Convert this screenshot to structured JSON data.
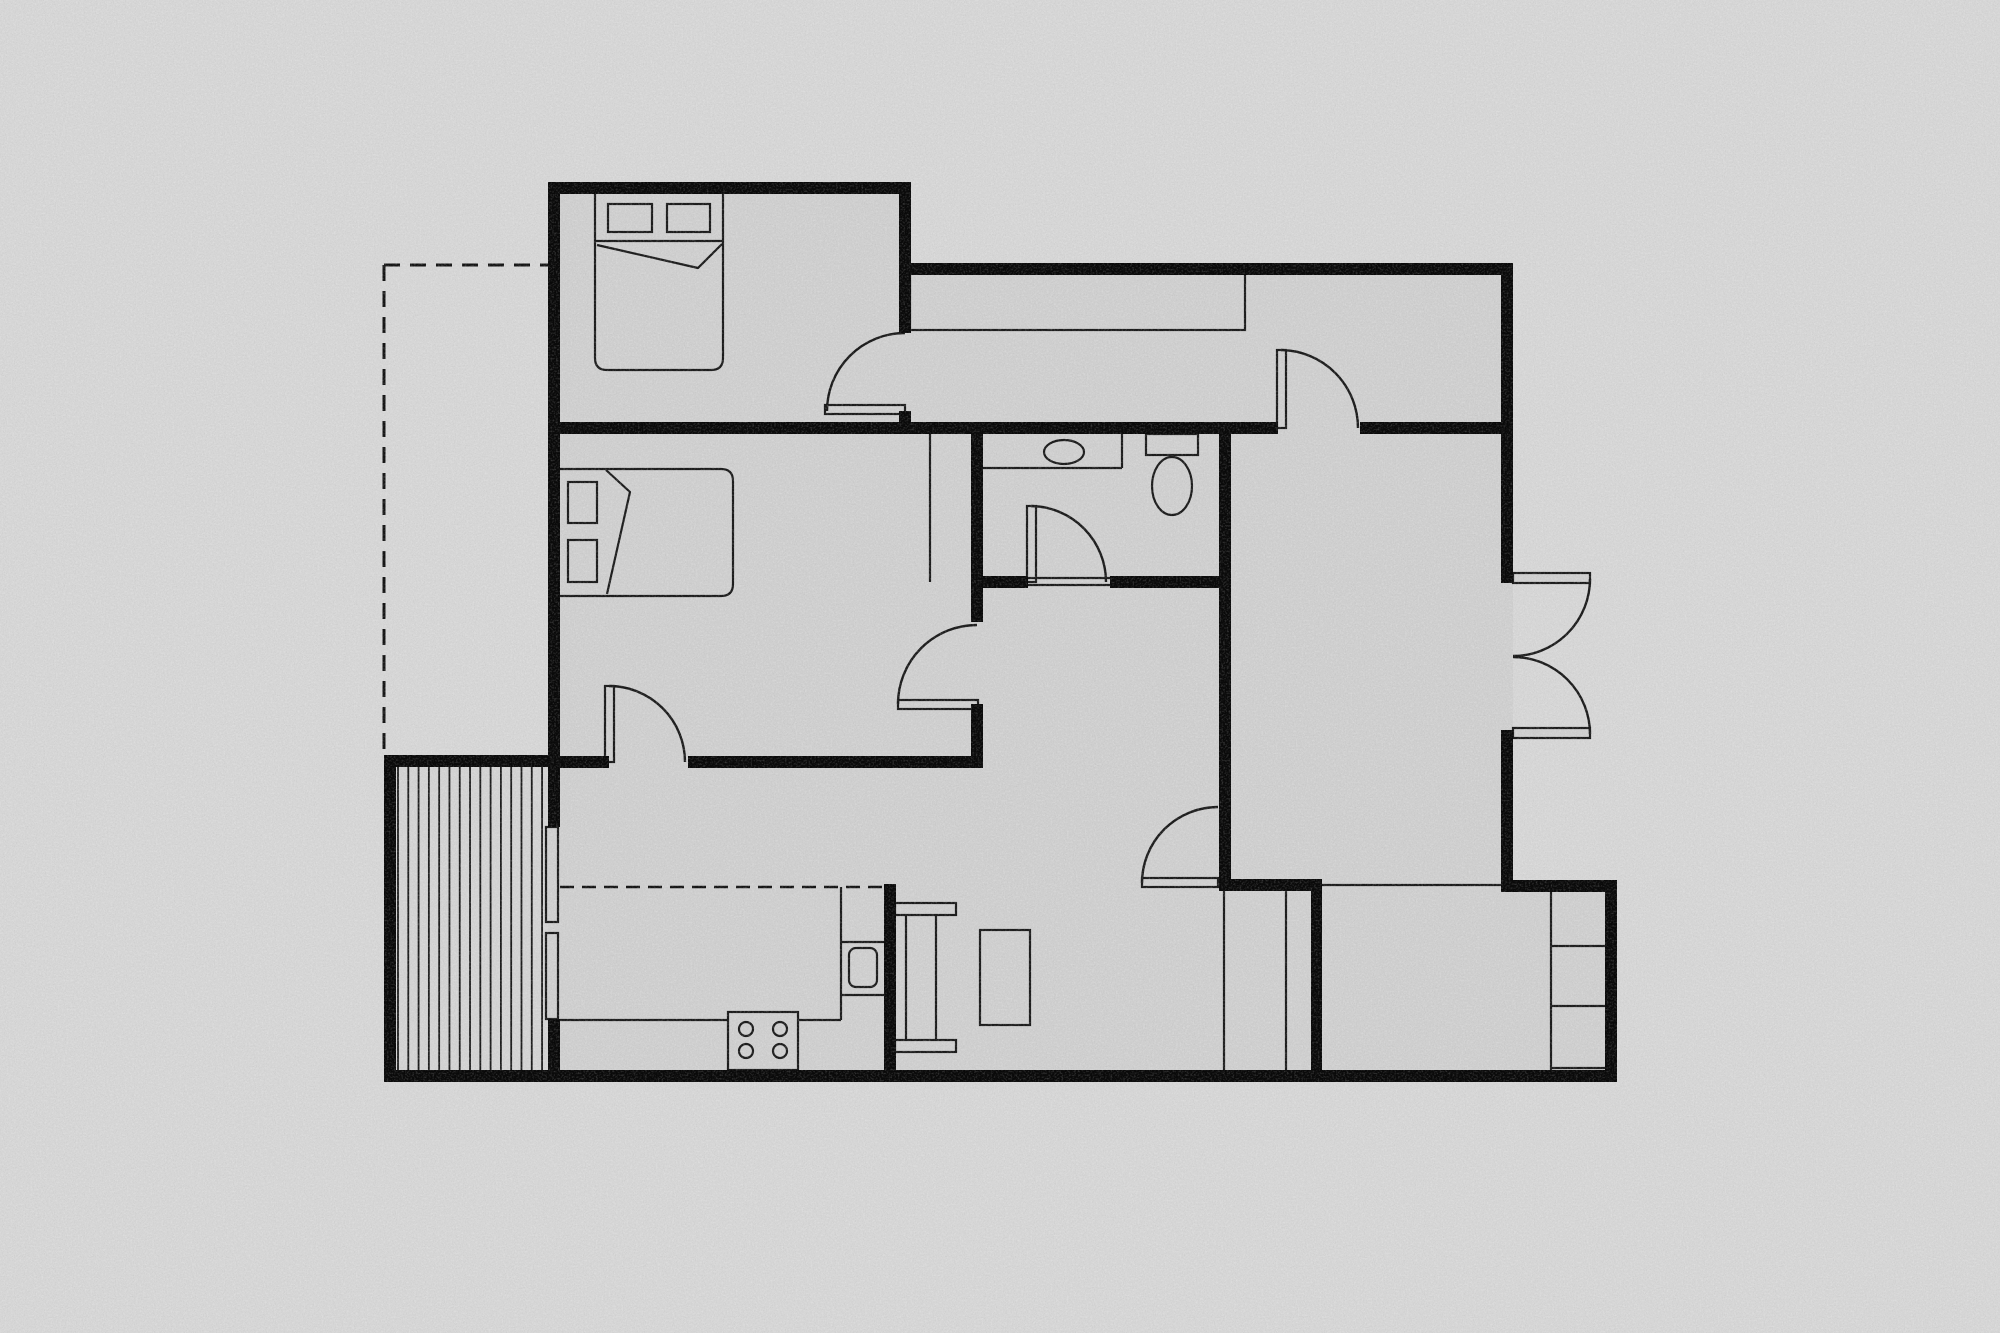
{
  "scene": {
    "width": 2000,
    "height": 1333,
    "background": "#d6d6d6",
    "floor_fill": "#cfcfcf",
    "deck_fill": "#d3d3d3",
    "wall_color": "#0a0a0a",
    "line_color": "#1c1c1c",
    "dash_color": "#151515",
    "thin_width": 2.2,
    "arc_width": 2.4
  },
  "floor_plan": {
    "floor": {
      "name": "floor-footprint",
      "points": "548,182 910,182 910,263 1513,263 1513,880 1617,880 1617,1082 384,1082 384,755 548,755"
    },
    "deck": {
      "name": "deck-patio",
      "x": 396,
      "y": 767,
      "w": 152,
      "h": 303,
      "stripe_x0": 398,
      "stripe_step": 10.29,
      "stripe_count": 15,
      "stripe_y0": 767,
      "stripe_y1": 1070
    },
    "walls": [
      {
        "name": "wall-left-upper",
        "x": 548,
        "y": 182,
        "w": 12,
        "h": 645
      },
      {
        "name": "wall-left-lower",
        "x": 548,
        "y": 1019,
        "w": 12,
        "h": 63
      },
      {
        "name": "wall-top-bedroom1",
        "x": 548,
        "y": 182,
        "w": 363,
        "h": 12
      },
      {
        "name": "wall-bedroom1-right-upper",
        "x": 899,
        "y": 182,
        "w": 12,
        "h": 151
      },
      {
        "name": "wall-bedroom1-right-stub",
        "x": 899,
        "y": 411,
        "w": 12,
        "h": 23
      },
      {
        "name": "wall-hall-top",
        "x": 905,
        "y": 263,
        "w": 608,
        "h": 12
      },
      {
        "name": "wall-right-upper",
        "x": 1501,
        "y": 263,
        "w": 12,
        "h": 320
      },
      {
        "name": "wall-right-lower",
        "x": 1501,
        "y": 730,
        "w": 12,
        "h": 162
      },
      {
        "name": "wall-step-top",
        "x": 1501,
        "y": 880,
        "w": 116,
        "h": 12
      },
      {
        "name": "wall-right-outer",
        "x": 1605,
        "y": 880,
        "w": 12,
        "h": 202
      },
      {
        "name": "wall-bottom",
        "x": 384,
        "y": 1070,
        "w": 1233,
        "h": 12
      },
      {
        "name": "wall-deck-left",
        "x": 384,
        "y": 755,
        "w": 12,
        "h": 327
      },
      {
        "name": "wall-deck-top",
        "x": 384,
        "y": 755,
        "w": 172,
        "h": 12
      },
      {
        "name": "wall-cross-main-left",
        "x": 548,
        "y": 422,
        "w": 730,
        "h": 12
      },
      {
        "name": "wall-cross-main-right",
        "x": 1360,
        "y": 422,
        "w": 153,
        "h": 12
      },
      {
        "name": "wall-a-upper",
        "x": 971,
        "y": 434,
        "w": 12,
        "h": 188
      },
      {
        "name": "wall-a-lower",
        "x": 971,
        "y": 704,
        "w": 12,
        "h": 64
      },
      {
        "name": "wall-bedroom2-bottom-left",
        "x": 548,
        "y": 756,
        "w": 61,
        "h": 12
      },
      {
        "name": "wall-bedroom2-bottom-right",
        "x": 688,
        "y": 756,
        "w": 295,
        "h": 12
      },
      {
        "name": "wall-bath-bottom-left",
        "x": 971,
        "y": 576,
        "w": 57,
        "h": 12
      },
      {
        "name": "wall-bath-bottom-right",
        "x": 1110,
        "y": 576,
        "w": 121,
        "h": 12
      },
      {
        "name": "wall-b",
        "x": 1219,
        "y": 434,
        "w": 12,
        "h": 451
      },
      {
        "name": "wall-kitchen-dining",
        "x": 884,
        "y": 884,
        "w": 12,
        "h": 198
      },
      {
        "name": "wall-closet-top",
        "x": 1219,
        "y": 879,
        "w": 103,
        "h": 12
      },
      {
        "name": "wall-closet-right",
        "x": 1311,
        "y": 885,
        "w": 11,
        "h": 187
      }
    ],
    "thin_lines": [
      {
        "name": "rightroom-bottom-line",
        "pts": [
          1322,
          885,
          1501,
          885
        ]
      },
      {
        "name": "closet-divider-1",
        "pts": [
          1224,
          891,
          1224,
          1070
        ]
      },
      {
        "name": "closet-divider-2",
        "pts": [
          1286,
          891,
          1286,
          1070
        ]
      },
      {
        "name": "shelf-closet-left",
        "pts": [
          1551,
          892,
          1551,
          1070
        ]
      },
      {
        "name": "shelf-closet-div-1",
        "pts": [
          1551,
          946,
          1605,
          946
        ]
      },
      {
        "name": "shelf-closet-div-2",
        "pts": [
          1551,
          1006,
          1605,
          1006
        ]
      },
      {
        "name": "shelf-closet-bottom",
        "pts": [
          1551,
          1068,
          1605,
          1068
        ]
      },
      {
        "name": "bedroom2-wardrobe-line",
        "pts": [
          930,
          434,
          930,
          582
        ]
      },
      {
        "name": "kitchen-counter-front-left",
        "pts": [
          560,
          1020,
          728,
          1020
        ]
      },
      {
        "name": "kitchen-counter-front-mid",
        "pts": [
          798,
          1020,
          841,
          1020
        ]
      },
      {
        "name": "kitchen-counter-side",
        "pts": [
          841,
          887,
          841,
          1020
        ]
      },
      {
        "name": "kitchen-counter-div-1",
        "pts": [
          841,
          942,
          884,
          942
        ]
      },
      {
        "name": "kitchen-counter-div-2",
        "pts": [
          841,
          995,
          884,
          995
        ]
      },
      {
        "name": "vanity-front",
        "pts": [
          983,
          468,
          1122,
          468
        ]
      },
      {
        "name": "vanity-side",
        "pts": [
          1122,
          434,
          1122,
          468
        ]
      },
      {
        "name": "bed1-head-line",
        "pts": [
          595,
          241,
          723,
          241
        ]
      },
      {
        "name": "bath-door-threshold-1",
        "pts": [
          1028,
          578,
          1110,
          578
        ]
      },
      {
        "name": "bath-door-threshold-2",
        "pts": [
          1028,
          585,
          1110,
          585
        ]
      },
      {
        "name": "console-leg-1",
        "pts": [
          906,
          915,
          906,
          1040
        ]
      },
      {
        "name": "console-leg-2",
        "pts": [
          936,
          915,
          936,
          1040
        ]
      }
    ],
    "dashed_lines": [
      {
        "name": "dashed-boundary-top",
        "pts": [
          384,
          265,
          548,
          265
        ],
        "dash": "16 10",
        "w": 3
      },
      {
        "name": "dashed-boundary-left",
        "pts": [
          384,
          265,
          384,
          755
        ],
        "dash": "16 10",
        "w": 3
      },
      {
        "name": "dashed-kitchen-overhead",
        "pts": [
          560,
          887,
          884,
          887
        ],
        "dash": "14 8",
        "w": 2.5
      }
    ],
    "outline_rects": [
      {
        "name": "hall-closet",
        "x": 910,
        "y": 272,
        "w": 335,
        "h": 58
      },
      {
        "name": "window-left-upper",
        "x": 546,
        "y": 827,
        "w": 12,
        "h": 95
      },
      {
        "name": "window-left-lower",
        "x": 546,
        "y": 933,
        "w": 12,
        "h": 86
      },
      {
        "name": "bed1-pillow-left",
        "x": 608,
        "y": 204,
        "w": 44,
        "h": 28
      },
      {
        "name": "bed1-pillow-right",
        "x": 667,
        "y": 204,
        "w": 43,
        "h": 28
      },
      {
        "name": "bed2-pillow-top",
        "x": 568,
        "y": 482,
        "w": 29,
        "h": 41
      },
      {
        "name": "bed2-pillow-bottom",
        "x": 568,
        "y": 540,
        "w": 29,
        "h": 42
      },
      {
        "name": "stove",
        "x": 728,
        "y": 1012,
        "w": 70,
        "h": 58
      },
      {
        "name": "kitchen-sink",
        "x": 849,
        "y": 948,
        "w": 28,
        "h": 39,
        "rx": 7
      },
      {
        "name": "toilet-tank",
        "x": 1146,
        "y": 434,
        "w": 52,
        "h": 21
      },
      {
        "name": "console-cap-top",
        "x": 895,
        "y": 903,
        "w": 61,
        "h": 12
      },
      {
        "name": "console-cap-bottom",
        "x": 895,
        "y": 1040,
        "w": 61,
        "h": 12
      },
      {
        "name": "dining-table",
        "x": 980,
        "y": 930,
        "w": 50,
        "h": 95
      },
      {
        "name": "door-leaf-bedroom1",
        "x": 825,
        "y": 405,
        "w": 80,
        "h": 9
      },
      {
        "name": "door-leaf-hall",
        "x": 1277,
        "y": 350,
        "w": 9,
        "h": 78
      },
      {
        "name": "door-leaf-bathroom",
        "x": 1027,
        "y": 506,
        "w": 9,
        "h": 76
      },
      {
        "name": "door-leaf-bedroom2-living",
        "x": 898,
        "y": 700,
        "w": 80,
        "h": 9
      },
      {
        "name": "door-leaf-bedroom2-kitchen",
        "x": 605,
        "y": 686,
        "w": 9,
        "h": 76
      },
      {
        "name": "door-leaf-living-dining",
        "x": 1142,
        "y": 878,
        "w": 76,
        "h": 9
      },
      {
        "name": "door-leaf-french-top",
        "x": 1513,
        "y": 573,
        "w": 77,
        "h": 10
      },
      {
        "name": "door-leaf-french-bottom",
        "x": 1513,
        "y": 728,
        "w": 77,
        "h": 10
      }
    ],
    "door_arcs": [
      {
        "name": "door-arc-bedroom1",
        "d": "M827,411 A78,78 0 0 1 905,333"
      },
      {
        "name": "door-arc-hall-rightroom",
        "d": "M1281,350 A78,78 0 0 1 1358,428"
      },
      {
        "name": "door-arc-bathroom",
        "d": "M1031,506 A76,76 0 0 1 1106,582"
      },
      {
        "name": "door-arc-bedroom2-living",
        "d": "M898,704 A79,79 0 0 1 977,625"
      },
      {
        "name": "door-arc-bedroom2-kitchen",
        "d": "M609,686 A76,76 0 0 1 685,762"
      },
      {
        "name": "door-arc-living-dining",
        "d": "M1142,883 A76,76 0 0 1 1218,807"
      },
      {
        "name": "door-arc-french-top",
        "d": "M1590,579 A77,77 0 0 1 1513,656"
      },
      {
        "name": "door-arc-french-bottom",
        "d": "M1513,657 A77,77 0 0 1 1590,734"
      }
    ],
    "furniture_paths": [
      {
        "name": "bed1-body",
        "d": "M595,192 L723,192 L723,358 Q723,370 711,370 L607,370 Q595,370 595,358 Z",
        "fill": true
      },
      {
        "name": "bed2-body",
        "d": "M556,469 L721,469 Q733,469 733,481 L733,584 Q733,596 721,596 L556,596 Z",
        "fill": true
      },
      {
        "name": "bed1-blanket-fold",
        "d": "M597,245 L698,268 L722,244",
        "fill": false
      },
      {
        "name": "bed2-blanket-fold",
        "d": "M606,470 L630,492 L607,594",
        "fill": false
      }
    ],
    "ellipses": [
      {
        "name": "bathroom-sink",
        "cx": 1064,
        "cy": 452,
        "rx": 20,
        "ry": 12
      },
      {
        "name": "toilet-bowl",
        "cx": 1172,
        "cy": 486,
        "rx": 20,
        "ry": 29
      }
    ],
    "circles": [
      {
        "name": "stove-burner-1",
        "cx": 746,
        "cy": 1029,
        "r": 7
      },
      {
        "name": "stove-burner-2",
        "cx": 780,
        "cy": 1029,
        "r": 7
      },
      {
        "name": "stove-burner-3",
        "cx": 746,
        "cy": 1051,
        "r": 7
      },
      {
        "name": "stove-burner-4",
        "cx": 780,
        "cy": 1051,
        "r": 7
      }
    ]
  }
}
